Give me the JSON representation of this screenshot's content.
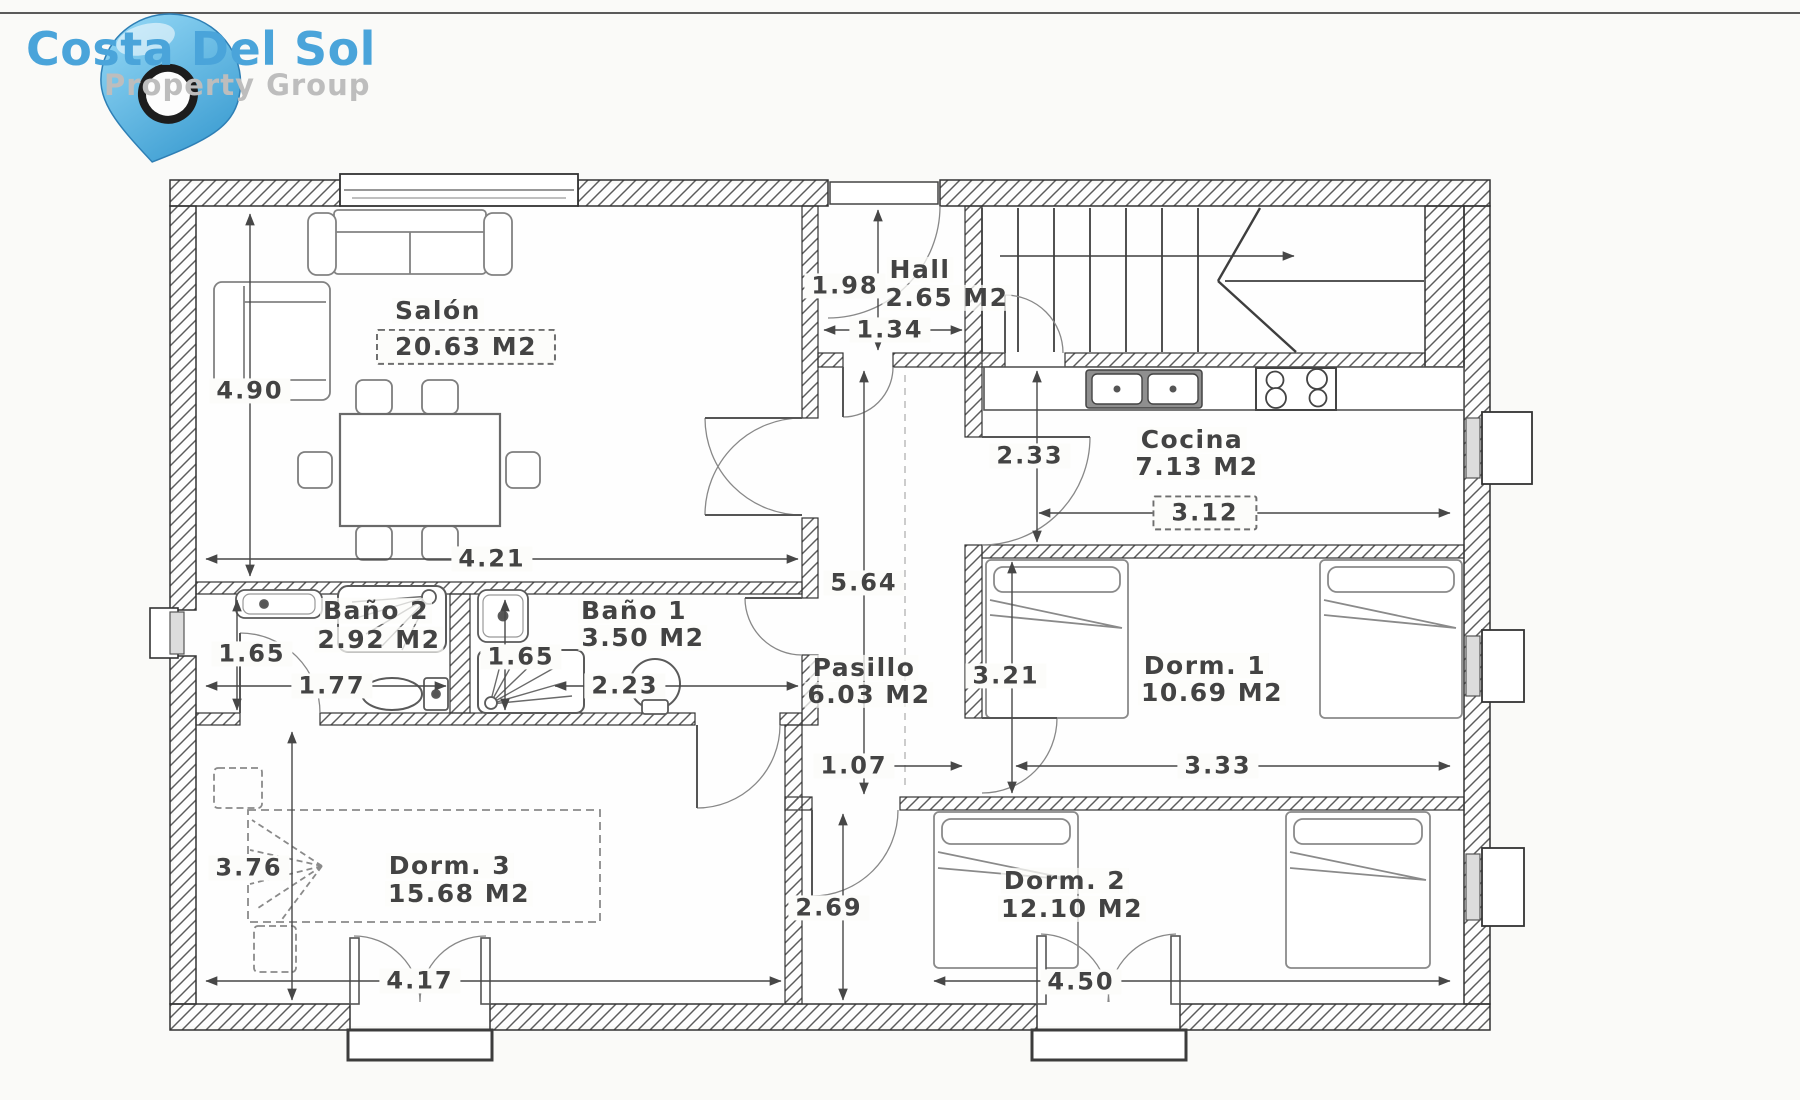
{
  "logo": {
    "title": "Costa Del Sol",
    "subtitle": "Property Group",
    "accent_color": "#4aa4da",
    "subtitle_color": "#bdbdbd",
    "pin_color": "#54b7e8"
  },
  "rooms": [
    {
      "id": "salon",
      "name": "Salón",
      "area": "20.63 M2"
    },
    {
      "id": "hall",
      "name": "Hall",
      "area": "2.65 M2"
    },
    {
      "id": "cocina",
      "name": "Cocina",
      "area": "7.13 M2"
    },
    {
      "id": "bano2",
      "name": "Baño 2",
      "area": "2.92 M2"
    },
    {
      "id": "bano1",
      "name": "Baño 1",
      "area": "3.50 M2"
    },
    {
      "id": "pasillo",
      "name": "Pasillo",
      "area": "6.03 M2"
    },
    {
      "id": "dorm1",
      "name": "Dorm. 1",
      "area": "10.69 M2"
    },
    {
      "id": "dorm2",
      "name": "Dorm. 2",
      "area": "12.10 M2"
    },
    {
      "id": "dorm3",
      "name": "Dorm. 3",
      "area": "15.68 M2"
    }
  ],
  "dimensions": [
    {
      "id": "salon-height",
      "value": "4.90"
    },
    {
      "id": "salon-width",
      "value": "4.21"
    },
    {
      "id": "hall-height",
      "value": "1.98"
    },
    {
      "id": "hall-width",
      "value": "1.34"
    },
    {
      "id": "cocina-height",
      "value": "2.33"
    },
    {
      "id": "cocina-width",
      "value": "3.12"
    },
    {
      "id": "pasillo-height",
      "value": "5.64"
    },
    {
      "id": "pasillo-width",
      "value": "1.07"
    },
    {
      "id": "bano2-height",
      "value": "1.65"
    },
    {
      "id": "bano2-width",
      "value": "1.77"
    },
    {
      "id": "bano1-height",
      "value": "1.65"
    },
    {
      "id": "bano1-width",
      "value": "2.23"
    },
    {
      "id": "dorm1-height",
      "value": "3.21"
    },
    {
      "id": "dorm1-width",
      "value": "3.33"
    },
    {
      "id": "dorm3-height",
      "value": "3.76"
    },
    {
      "id": "dorm3-width",
      "value": "4.17"
    },
    {
      "id": "dorm2-height",
      "value": "2.69"
    },
    {
      "id": "dorm2-width",
      "value": "4.50"
    }
  ]
}
